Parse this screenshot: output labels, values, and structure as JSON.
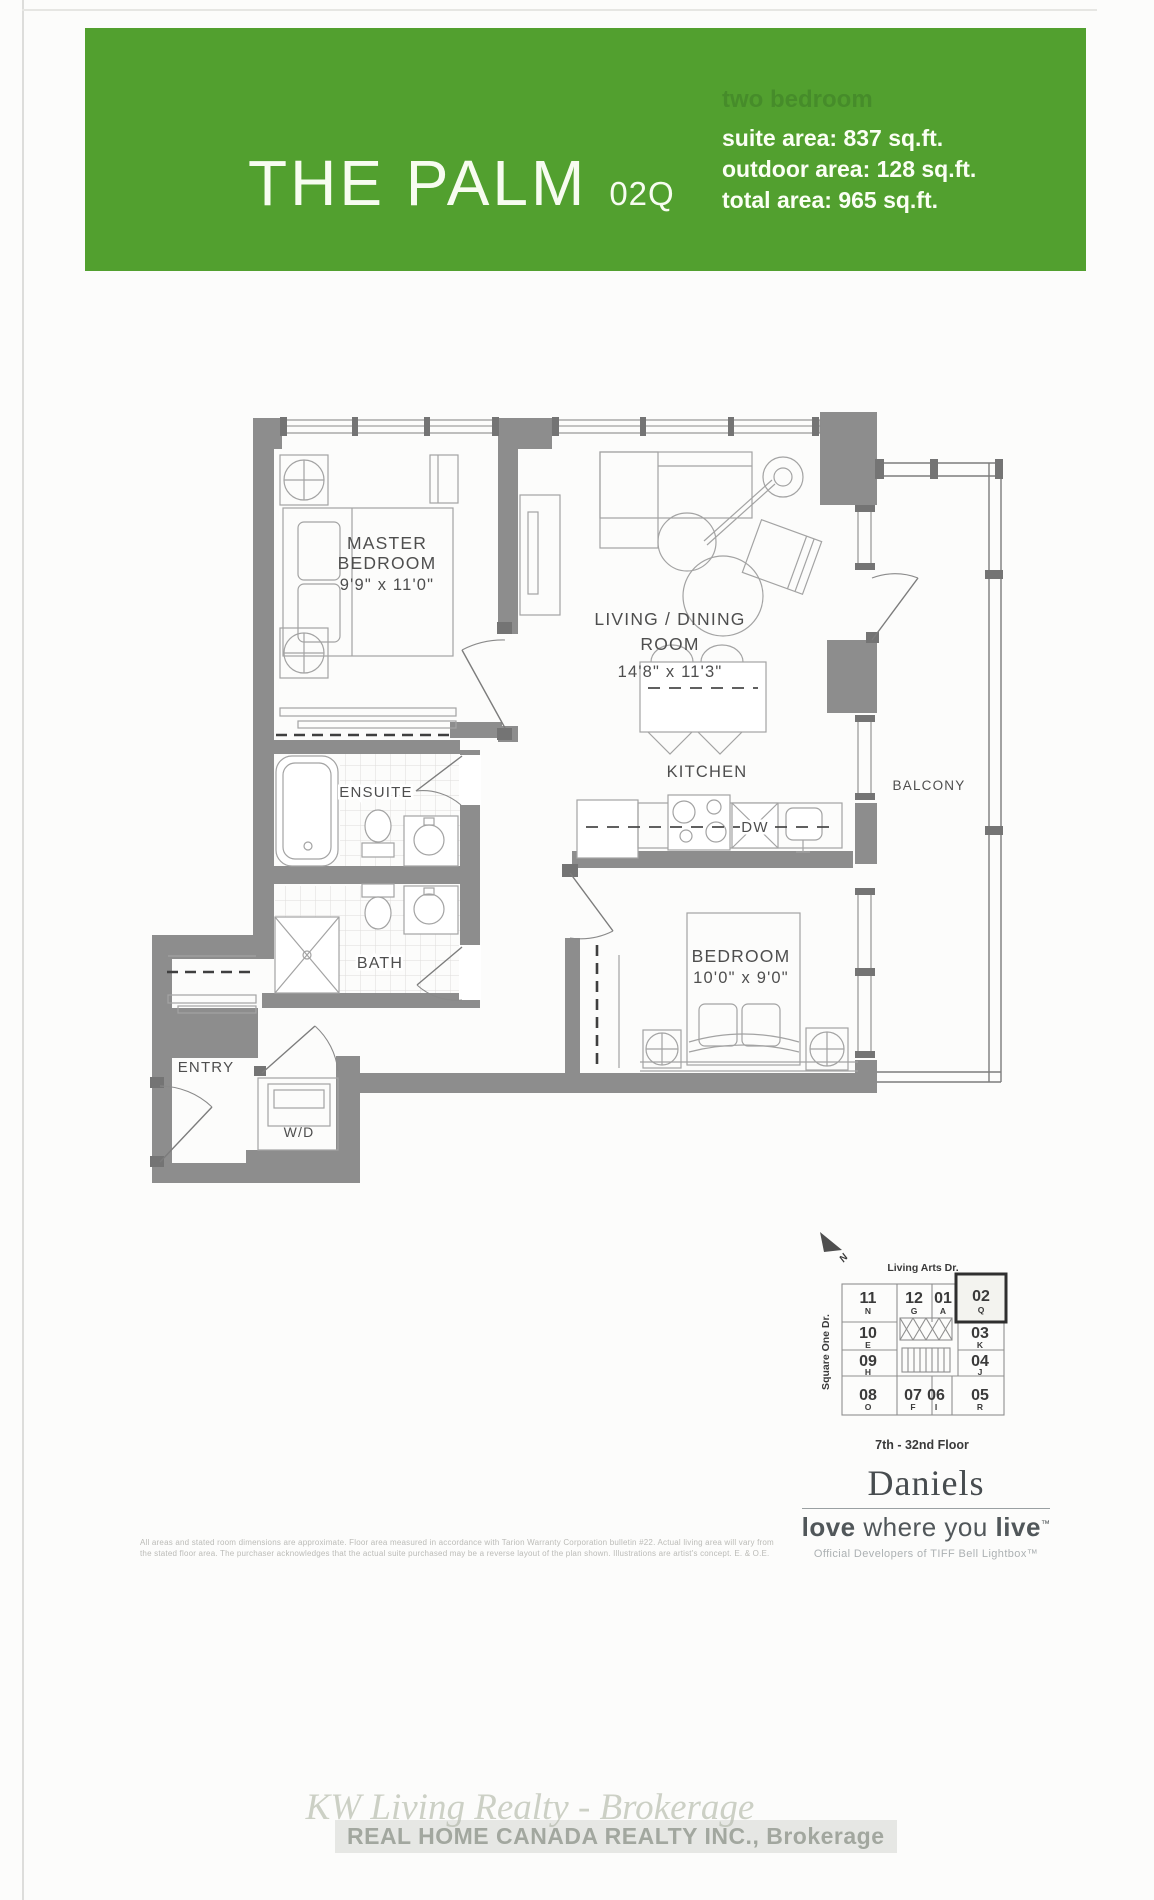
{
  "header": {
    "title": "THE PALM",
    "unit_code": "02Q",
    "type_label": "two bedroom",
    "stats": [
      "suite area: 837 sq.ft.",
      "outdoor area: 128 sq.ft.",
      "total area: 965 sq.ft."
    ],
    "banner_color": "#52a02f"
  },
  "plan": {
    "master": {
      "l1": "MASTER",
      "l2": "BEDROOM",
      "dims": "9'9\" x 11'0\""
    },
    "living": {
      "l1": "LIVING / DINING",
      "l2": "ROOM",
      "dims": "14'8\" x 11'3\""
    },
    "kitchen": "KITCHEN",
    "dw": "DW",
    "ensuite": "ENSUITE",
    "bath": "BATH",
    "entry": "ENTRY",
    "wd": "W/D",
    "balcony": "BALCONY",
    "bedroom2": {
      "l1": "BEDROOM",
      "dims": "10'0\" x 9'0\""
    }
  },
  "keyplan": {
    "north": "N",
    "street_top": "Living Arts Dr.",
    "street_left": "Square One Dr.",
    "floors": "7th - 32nd Floor",
    "units": [
      {
        "num": "11",
        "letter": "N"
      },
      {
        "num": "12",
        "letter": "G"
      },
      {
        "num": "01",
        "letter": "A"
      },
      {
        "num": "02",
        "letter": "Q",
        "highlighted": true
      },
      {
        "num": "10",
        "letter": "E"
      },
      {
        "num": "03",
        "letter": "K"
      },
      {
        "num": "09",
        "letter": "H"
      },
      {
        "num": "04",
        "letter": "J"
      },
      {
        "num": "08",
        "letter": "O"
      },
      {
        "num": "07",
        "letter": "F"
      },
      {
        "num": "06",
        "letter": "I"
      },
      {
        "num": "05",
        "letter": "R"
      }
    ]
  },
  "branding": {
    "name": "Daniels",
    "tagline": {
      "b1": "love",
      "mid": " where you ",
      "b2": "live",
      "tm": "™"
    },
    "subtitle": "Official Developers of TIFF Bell Lightbox™"
  },
  "disclaimer": {
    "line1": "All areas and stated room dimensions are approximate. Floor area measured in accordance with Tarion Warranty Corporation bulletin #22. Actual living area will vary from",
    "line2": "the stated floor area. The purchaser acknowledges that the actual suite purchased may be a reverse layout of the plan shown. Illustrations are artist's concept. E. & O.E."
  },
  "watermark": {
    "line1": "KW Living Realty - Brokerage",
    "line2": "REAL HOME CANADA REALTY INC., Brokerage"
  }
}
